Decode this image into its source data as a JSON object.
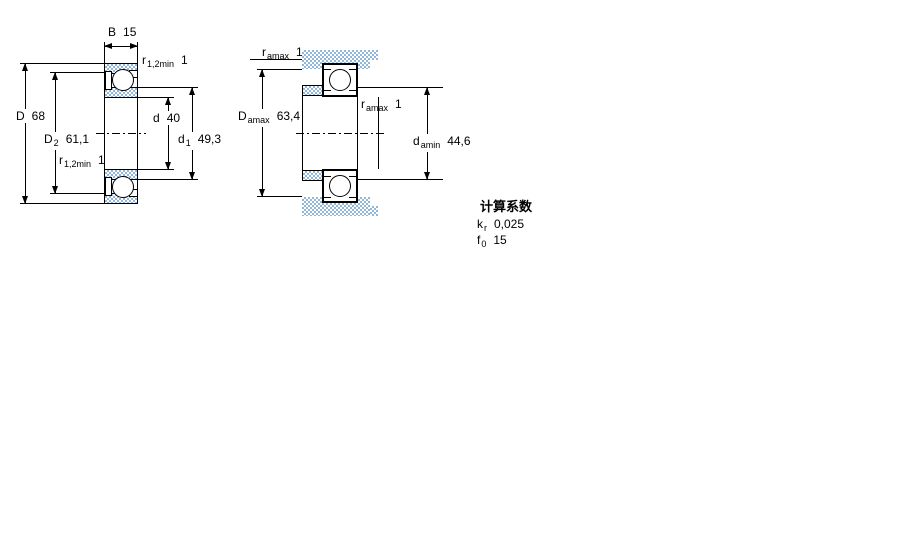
{
  "left_drawing": {
    "B": {
      "base": "B",
      "value": "15"
    },
    "r_top": {
      "base": "r",
      "sub": "1,2min",
      "value": "1"
    },
    "D": {
      "base": "D",
      "value": "68"
    },
    "D2": {
      "base": "D",
      "sub": "2",
      "value": "61,1"
    },
    "r_mid": {
      "base": "r",
      "sub": "1,2min",
      "value": "1"
    },
    "d": {
      "base": "d",
      "value": "40"
    },
    "d1": {
      "base": "d",
      "sub": "1",
      "value": "49,3"
    }
  },
  "right_drawing": {
    "ra_top": {
      "base": "r",
      "sub": "amax",
      "value": "1"
    },
    "Da": {
      "base": "D",
      "sub": "amax",
      "value": "63,4"
    },
    "ra_mid": {
      "base": "r",
      "sub": "amax",
      "value": "1"
    },
    "da": {
      "base": "d",
      "sub": "amin",
      "value": "44,6"
    }
  },
  "calc_factors": {
    "title": "计算系数",
    "kr": {
      "base": "k",
      "sub": "r",
      "value": "0,025"
    },
    "f0": {
      "base": "f",
      "sub": "0",
      "value": "15"
    }
  },
  "colors": {
    "line": "#000000",
    "section_fill": "#92b7d8",
    "background": "#ffffff"
  }
}
